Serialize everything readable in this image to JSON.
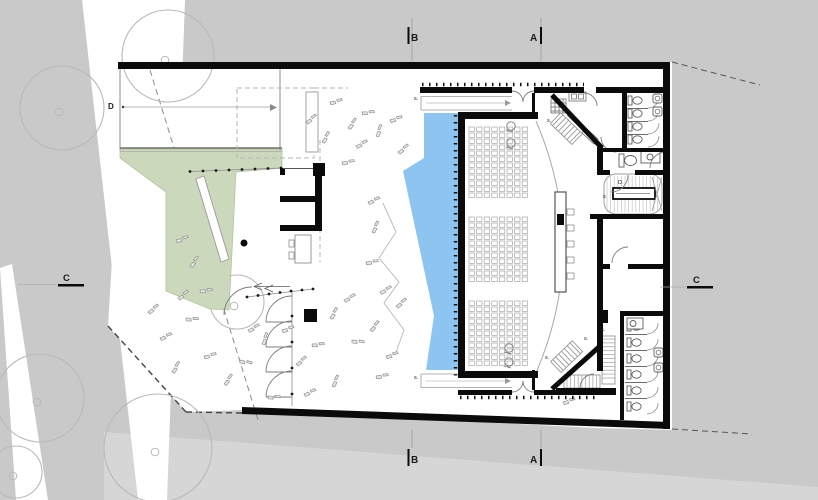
{
  "plan": {
    "colors": {
      "background": "#c9c9c9",
      "site_white": "#ffffff",
      "road_white": "#ffffff",
      "bottom_wedge": "#d6d6d6",
      "green_area": "#ccd8bc",
      "water": "#8ec4f0",
      "wall_black": "#0b0b0b",
      "thin_line": "#8a8a8a",
      "tree_outline": "#b9b9b9"
    },
    "markers": {
      "section_top": [
        {
          "label": "B",
          "x": 411,
          "y": 41
        },
        {
          "label": "A",
          "x": 530,
          "y": 41
        }
      ],
      "section_bottom": [
        {
          "label": "B",
          "x": 411,
          "y": 463
        },
        {
          "label": "A",
          "x": 530,
          "y": 463
        }
      ],
      "section_left": {
        "label": "C",
        "x": 63,
        "y": 281
      },
      "section_right": {
        "label": "C",
        "x": 693,
        "y": 283
      },
      "detail": {
        "label": "D",
        "x": 108,
        "y": 109
      }
    },
    "stair_labels": [
      {
        "x": 414,
        "y": 100,
        "t": "s."
      },
      {
        "x": 414,
        "y": 379,
        "t": "s."
      },
      {
        "x": 547,
        "y": 122,
        "t": "s."
      },
      {
        "x": 545,
        "y": 359,
        "t": "s."
      },
      {
        "x": 557,
        "y": 384,
        "t": "s."
      },
      {
        "x": 601,
        "y": 331,
        "t": "s."
      },
      {
        "x": 603,
        "y": 198,
        "t": "s"
      },
      {
        "x": 618,
        "y": 184,
        "t": "D."
      },
      {
        "x": 584,
        "y": 340,
        "t": "s."
      }
    ],
    "trees": [
      {
        "x": 62,
        "y": 108,
        "r": 42
      },
      {
        "x": 168,
        "y": 56,
        "r": 46
      },
      {
        "x": 40,
        "y": 398,
        "r": 44
      },
      {
        "x": 158,
        "y": 448,
        "r": 54
      },
      {
        "x": 237,
        "y": 302,
        "r": 27
      },
      {
        "x": 16,
        "y": 472,
        "r": 26
      }
    ],
    "plants": [
      [
        160,
        338,
        15
      ],
      [
        172,
        372,
        -20
      ],
      [
        186,
        318,
        40
      ],
      [
        178,
        298,
        0
      ],
      [
        204,
        356,
        25
      ],
      [
        224,
        384,
        -15
      ],
      [
        248,
        330,
        10
      ],
      [
        240,
        360,
        50
      ],
      [
        262,
        344,
        -30
      ],
      [
        282,
        330,
        20
      ],
      [
        296,
        364,
        0
      ],
      [
        312,
        344,
        35
      ],
      [
        330,
        318,
        -20
      ],
      [
        344,
        300,
        10
      ],
      [
        352,
        340,
        45
      ],
      [
        370,
        330,
        -10
      ],
      [
        386,
        356,
        20
      ],
      [
        396,
        306,
        0
      ],
      [
        376,
        376,
        30
      ],
      [
        332,
        386,
        -25
      ],
      [
        304,
        394,
        15
      ],
      [
        268,
        396,
        40
      ],
      [
        306,
        122,
        0
      ],
      [
        330,
        102,
        25
      ],
      [
        348,
        128,
        -15
      ],
      [
        362,
        112,
        35
      ],
      [
        356,
        146,
        10
      ],
      [
        376,
        136,
        -30
      ],
      [
        390,
        120,
        20
      ],
      [
        398,
        152,
        0
      ],
      [
        342,
        162,
        30
      ],
      [
        322,
        142,
        -20
      ],
      [
        176,
        240,
        20
      ],
      [
        190,
        266,
        -15
      ],
      [
        200,
        290,
        35
      ],
      [
        148,
        312,
        0
      ],
      [
        368,
        202,
        15
      ],
      [
        372,
        232,
        -25
      ],
      [
        366,
        262,
        30
      ],
      [
        380,
        292,
        10
      ],
      [
        563,
        402,
        20
      ]
    ],
    "fence_posts": [
      [
        190,
        171.5
      ],
      [
        203,
        171
      ],
      [
        216,
        170.5
      ],
      [
        229,
        170
      ],
      [
        242,
        169.5
      ],
      [
        255,
        169
      ],
      [
        268,
        168.5
      ],
      [
        281,
        168
      ],
      [
        247,
        297
      ],
      [
        258,
        295.5
      ],
      [
        269,
        294
      ],
      [
        280,
        292.5
      ],
      [
        291,
        291
      ],
      [
        302,
        290
      ],
      [
        313,
        289
      ],
      [
        292,
        316
      ],
      [
        292,
        342
      ],
      [
        292,
        368
      ],
      [
        292,
        394
      ]
    ],
    "seating": {
      "rows_y0": 127,
      "rows_y1": 368,
      "pitch": 6,
      "seat_h": 4.4,
      "cols_x0": 469,
      "col_pitch": 7.6,
      "cols": 8,
      "seat_w": 5.4,
      "aisles": [
        [
          202,
          214
        ],
        [
          287,
          299
        ]
      ]
    },
    "head_table_chairs_y": [
      209,
      225,
      241,
      257,
      273
    ],
    "wheelchair_positions": [
      [
        511,
        126
      ],
      [
        511,
        143
      ],
      [
        509,
        348
      ],
      [
        509,
        362
      ]
    ],
    "restroom_top": {
      "toilets_x": 628,
      "toilets_y": [
        96,
        109,
        122,
        135
      ],
      "sinks_x": 653,
      "sinks_y": [
        94,
        107
      ]
    },
    "restroom_bottom": {
      "toilets_x": 627,
      "toilets_y": [
        322,
        338,
        354,
        370,
        386,
        402
      ],
      "sinks_x": 654,
      "sinks_y": [
        348,
        363
      ]
    }
  }
}
